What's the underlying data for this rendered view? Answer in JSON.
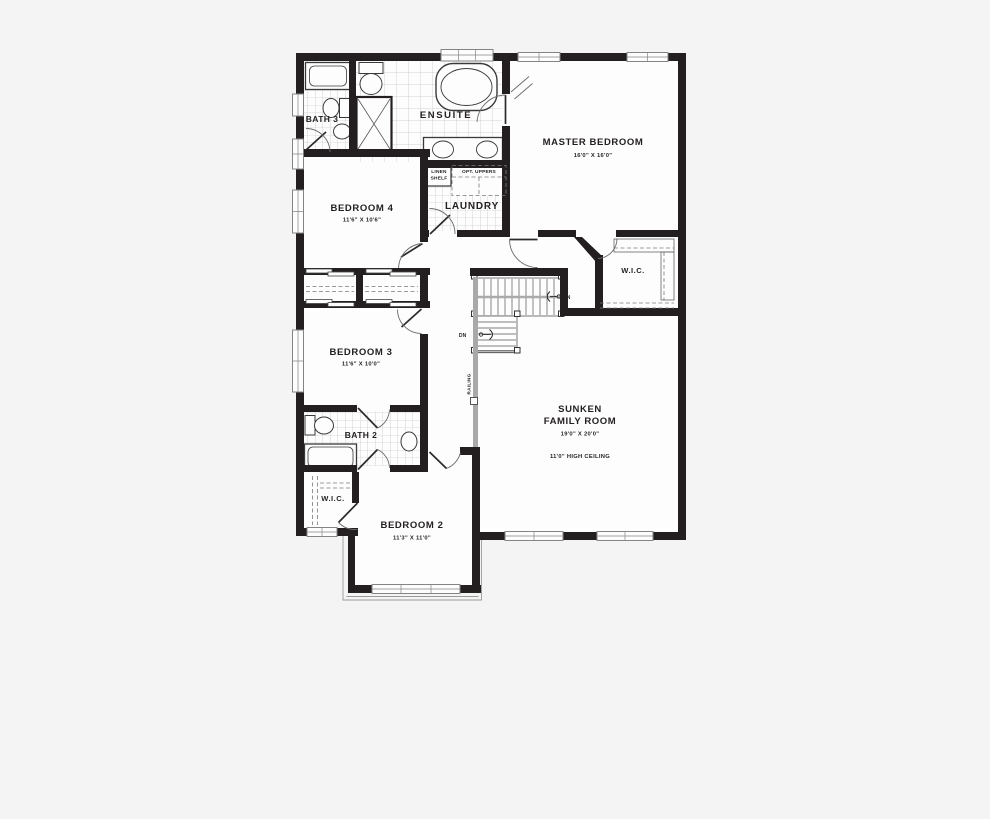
{
  "colors": {
    "background": "#f4f4f5",
    "wall": "#231f20",
    "room_fill": "#fdfdfd",
    "tile_line_small": "#b9b9b9",
    "tile_line_large": "#c3c3c3",
    "fixture_line": "#3a3a3a",
    "window_line": "#848484",
    "railing": "#a9a9a9",
    "dashed_line": "#7a7a7a",
    "label_text": "#231f20"
  },
  "rooms": {
    "bath3": {
      "label": "BATH 3"
    },
    "ensuite": {
      "label": "ENSUITE"
    },
    "master_bedroom": {
      "label": "MASTER BEDROOM",
      "dims": "16'0\" X 16'0\""
    },
    "bedroom4": {
      "label": "BEDROOM 4",
      "dims": "11'6\" X 10'6\""
    },
    "linen_shelf": {
      "line1": "LINEN",
      "line2": "SHELF"
    },
    "opt_uppers": {
      "label": "OPT. UPPERS"
    },
    "laundry": {
      "label": "LAUNDRY"
    },
    "wic_master": {
      "label": "W.I.C."
    },
    "bedroom3": {
      "label": "BEDROOM 3",
      "dims": "11'6\" X 10'0\""
    },
    "family_room": {
      "line1": "SUNKEN",
      "line2": "FAMILY ROOM",
      "dims": "19'0\" X 20'0\"",
      "note": "11'0\" HIGH CEILING"
    },
    "bath2": {
      "label": "BATH 2"
    },
    "wic_bedroom2": {
      "label": "W.I.C."
    },
    "bedroom2": {
      "label": "BEDROOM 2",
      "dims": "11'3\" X 11'0\""
    }
  },
  "stairs": {
    "upper_down": "DN",
    "lower_down": "DN",
    "railing": "RAILING"
  }
}
